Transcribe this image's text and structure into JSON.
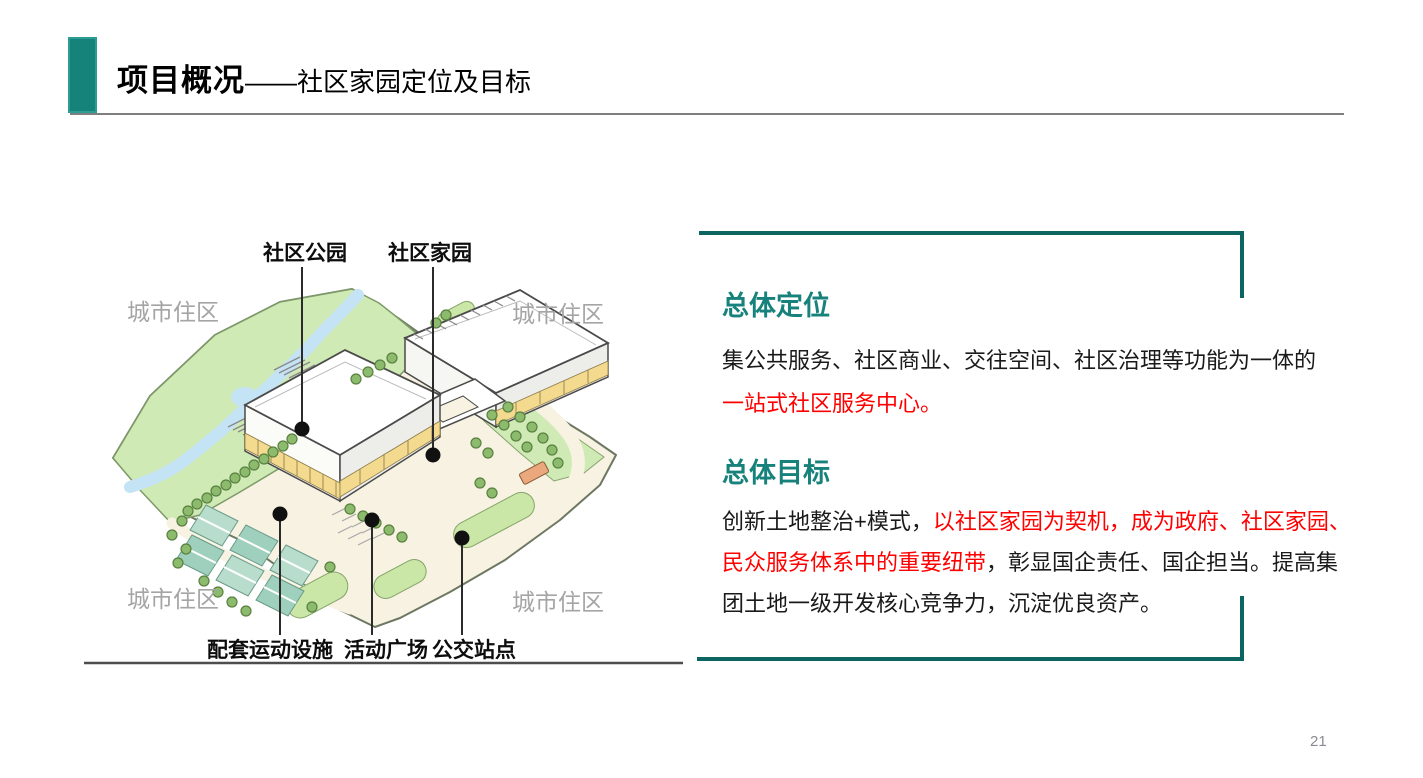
{
  "header": {
    "title_bold": "项目概况",
    "title_rest": "——社区家园定位及目标"
  },
  "diagram": {
    "label_park": "社区公园",
    "label_home": "社区家园",
    "label_urban": "城市住区",
    "label_sports": "配套运动设施",
    "label_plaza": "活动广场",
    "label_bus": "公交站点"
  },
  "panel": {
    "positioning": {
      "title": "总体定位",
      "line1_black": "集公共服务、社区商业、交往空间、社区治理等功能为一体的",
      "line2_red": "一站式社区服务中心。"
    },
    "goal": {
      "title": "总体目标",
      "seg1_black": "创新土地整治+模式，",
      "seg2_red": "以社区家园为契机，成为政府、社区家园、",
      "seg3_red": "民众服务体系中的重要纽带",
      "seg4_black": "，彰显国企责任、国企担当。提高集",
      "seg5_black": "团土地一级开发核心竞争力，沉淀优良资产。"
    }
  },
  "footer": {
    "page_number": "21"
  },
  "colors": {
    "teal_heading": "#17827b",
    "teal_bar": "#16837b",
    "panel_border": "#0d6561",
    "red_text": "#ff0000",
    "gray_label": "#a5a5a5"
  }
}
